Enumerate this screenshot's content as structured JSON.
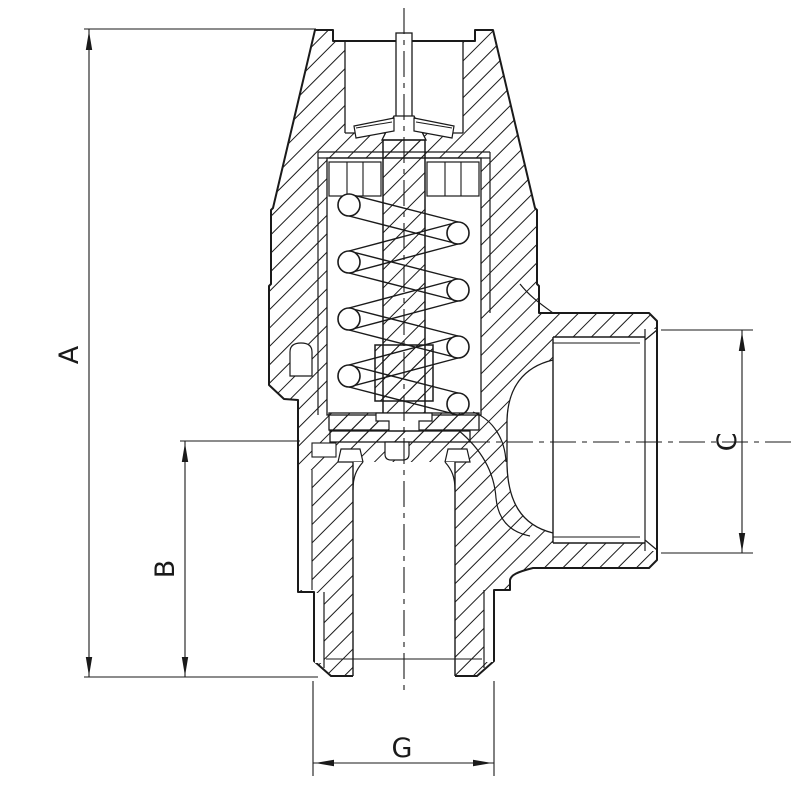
{
  "drawing": {
    "kind": "valve-cross-section-technical-drawing",
    "background_color": "#ffffff",
    "line_color": "#1a1a1a",
    "dimensions": {
      "overall_height_label": "A",
      "lower_height_label": "B",
      "side_port_label": "C",
      "thread_label": "G"
    }
  }
}
